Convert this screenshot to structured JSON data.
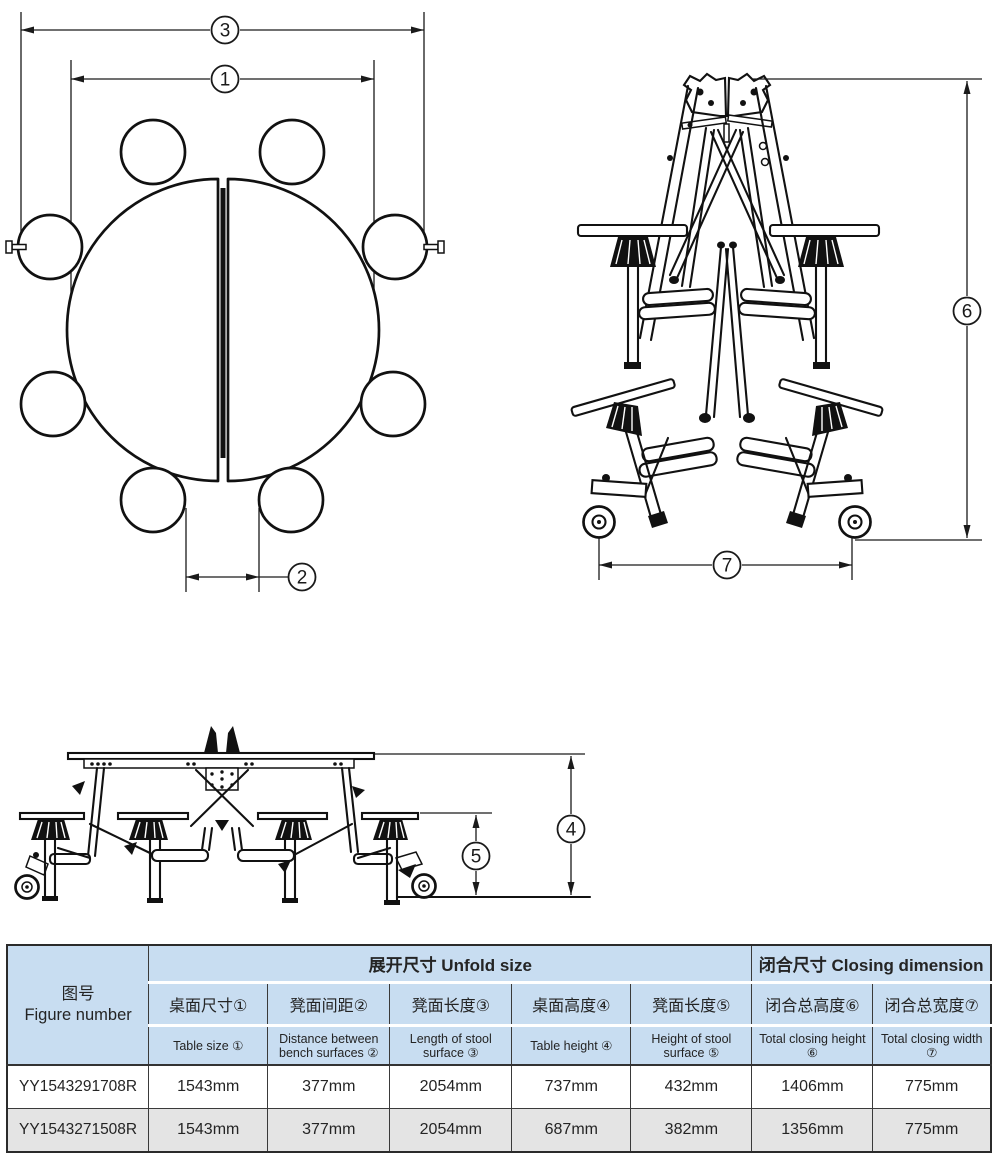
{
  "table": {
    "figure_header": {
      "zh": "图号",
      "en": "Figure number"
    },
    "groups": {
      "unfold": "展开尺寸 Unfold size",
      "closing": "闭合尺寸 Closing dimension"
    },
    "columns_zh": [
      "桌面尺寸①",
      "凳面间距②",
      "凳面长度③",
      "桌面高度④",
      "凳面长度⑤",
      "闭合总高度⑥",
      "闭合总宽度⑦"
    ],
    "columns_en": [
      "Table size ①",
      "Distance between bench surfaces ②",
      "Length of stool surface ③",
      "Table height ④",
      "Height of stool surface ⑤",
      "Total closing height ⑥",
      "Total closing width ⑦"
    ],
    "rows": [
      {
        "figure": "YY1543291708R",
        "values": [
          "1543mm",
          "377mm",
          "2054mm",
          "737mm",
          "432mm",
          "1406mm",
          "775mm"
        ]
      },
      {
        "figure": "YY1543271508R",
        "values": [
          "1543mm",
          "377mm",
          "2054mm",
          "687mm",
          "382mm",
          "1356mm",
          "775mm"
        ]
      }
    ]
  },
  "diagrams": {
    "top_view": {
      "dims": {
        "d1": "1",
        "d2": "2",
        "d3": "3"
      }
    },
    "folded_view": {
      "dims": {
        "d6": "6",
        "d7": "7"
      }
    },
    "side_view": {
      "dims": {
        "d4": "4",
        "d5": "5"
      }
    }
  },
  "colors": {
    "header_bg": "#c8ddf1",
    "alt_row_bg": "#e4e4e4",
    "line": "#1a1a1a",
    "border": "#3a3a3a"
  }
}
